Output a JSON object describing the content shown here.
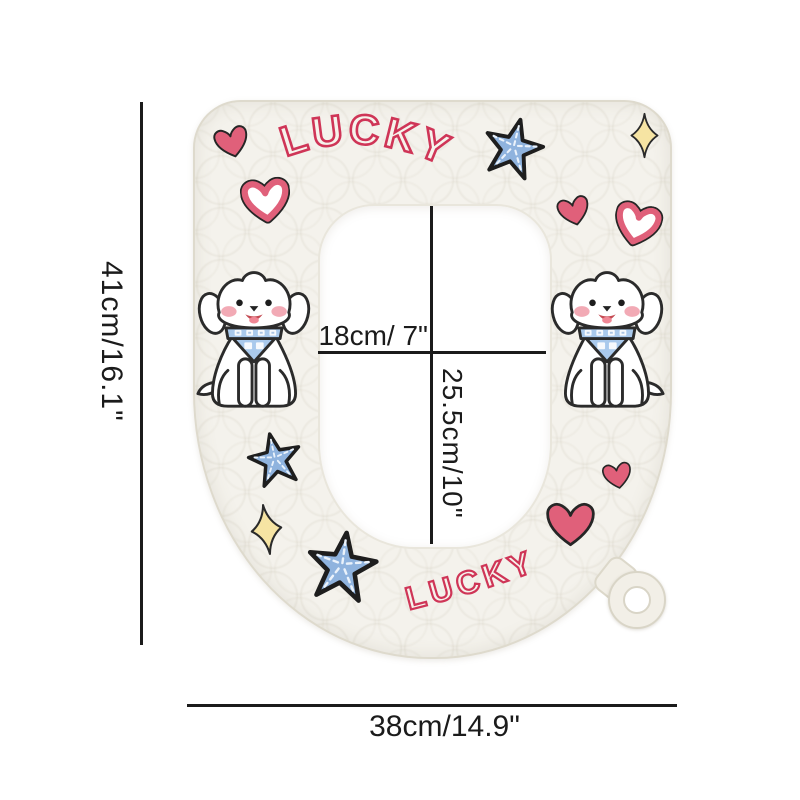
{
  "seat_text": {
    "top": "LUCKY",
    "bottom": "LUCKY"
  },
  "annotations": {
    "outer_height": "41cm/16.1\"",
    "outer_width": "38cm/14.9\"",
    "inner_width": "18cm/ 7\"",
    "inner_height": "25.5cm/10\""
  },
  "icons": {
    "hearts_solid_count": 4,
    "hearts_outline_count": 2,
    "starfish_count": 3,
    "sparkle_count": 2,
    "dog_count": 2,
    "hang_ring_count": 1
  },
  "colors": {
    "background": "#ffffff",
    "seat": "#f4f2ec",
    "seat_edge": "#dedacd",
    "lucky_red": "#cf3557",
    "heart_pink": "#e0607a",
    "starfish_blue": "#8fb3de",
    "starfish_dash": "#eaf2fb",
    "sparkle_yellow": "#f6e4a3",
    "bandana_blue": "#a9c9ec",
    "dog_cheek_pink": "#f2aab5",
    "dimension_ink": "#1b1b1b"
  }
}
